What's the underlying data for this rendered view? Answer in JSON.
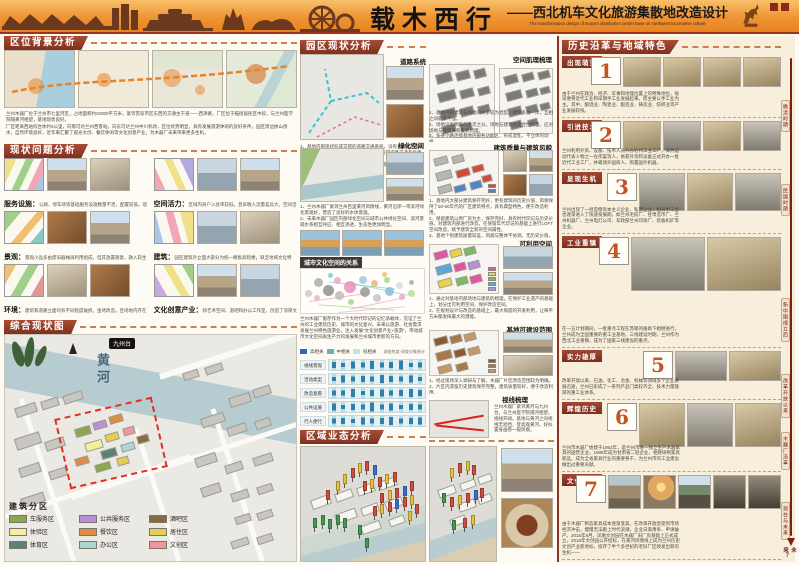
{
  "header": {
    "title": "载木西行",
    "subtitle_cn": "——西北机车文化旅游集散地改造设计",
    "subtitle_en": "The transformation design of tourism distribution center base on northwest locomotive culture"
  },
  "col1": {
    "s1": {
      "title": "区位背景分析",
      "para1": "兰州木器厂位于兰州市七里河区，占地面积约20000平方米，紧邻贯穿市区东西的交通主干道——西津路，厂区位于临街居民区中段，与兰州医学院隔黄河相望，基地现状良好。",
      "para2": "厂区距离西站综合体约5公里，向南可达兰州西客站，向东可达兰州中川机场，区位优势明显，具有发展旅游休闲的良好条件。园区周边依山傍水，自然环境良好，近年来汇聚了观光文创、餐饮休闲等文化创意产业，为木器厂未来带来更多生机。"
    },
    "s2": {
      "title": "现状问题分析",
      "items": [
        {
          "label": "服务设施",
          "text": "公厕、停车场等基础服务设施数量不足，配置较低。现有自行车辆服务基地基本被私家车占用。"
        },
        {
          "label": "空间活力",
          "text": "区域内商户入驻率较低，且早晚人流量差异大，空间活力不足。"
        },
        {
          "label": "景观",
          "text": "景观小品多由废旧器械再利用组成，但其放置随意，融入较生硬，与游客互动少。"
        },
        {
          "label": "建筑",
          "text": "园区建筑外立面大部分为统一模板高程楼，缺乏地域文化特色。各建筑为单体结构，缺乏空间联通。"
        },
        {
          "label": "环境",
          "text": "建筑和道路立面均有不同程度破损，亟待改造。且场地内存在物品乱堆砌现象，有安全隐患。"
        },
        {
          "label": "文化创意产业",
          "text": "除艺术空间、酒吧和办公工作室，创造了浓厚文化氛围，但受到狭窄空间限制，没有形成规模产业链。"
        }
      ]
    },
    "s3": {
      "title": "综合现状图",
      "river_label": "黄河",
      "badge": "九州台",
      "legend_title": "建筑分区",
      "legend": [
        {
          "label": "车服务区",
          "color": "#8ca84e"
        },
        {
          "label": "公共服务区",
          "color": "#b98fd6"
        },
        {
          "label": "酒吧区",
          "color": "#8a6a42"
        },
        {
          "label": "体验区",
          "color": "#f2eda0"
        },
        {
          "label": "餐饮区",
          "color": "#df8c44"
        },
        {
          "label": "居住区",
          "color": "#e3cf52"
        },
        {
          "label": "体育区",
          "color": "#5e8173"
        },
        {
          "label": "办公区",
          "color": "#a9d6d2"
        },
        {
          "label": "文创区",
          "color": "#f2959c"
        }
      ]
    }
  },
  "col2": {
    "title": "园区现状分析",
    "road": {
      "label": "道路系统",
      "text": "1、基地内部现状形成交错的道路交通系统，没有太多车行与步行的区分，道路与设施不协调，应对基地内部道路交通系统重新规划，形成分级、高效的道路交通系统。\n2、规划应考虑未来基地作为西北机车文化旅游集散地的车辆、停车需求，可考虑地下停车场的建设。"
    },
    "green": {
      "label": "绿化空间",
      "text": "1、兰州木器厂紧邻兰州百里黄河风情线，黄河沿岸一带滨河绿化景观好，营造了良好的水体景观。\n2、未来木器厂园区内部绿化空间与城市公共绿化空间、滨河景观水系相互呼应、相互渗透，生态性更加明显。"
    },
    "culture": {
      "label": "城市文化空间的关系",
      "text": "兰州木器厂留存作为一个大时代印记的记忆承载体，见证了兰州的工业建筑历史、城市的文化复兴。未来以旅游、社会需求发展兰州特色旅游业，注入发展“文化创意产业+旅游”，带动城市文化空间再生产力的发展和兰州城市更新的方向。",
      "legend": [
        {
          "label": "高相关",
          "color": "#2b6cb0"
        },
        {
          "label": "中相关",
          "color": "#63b3bd"
        },
        {
          "label": "低相关",
          "color": "#bee3ea"
        }
      ],
      "note": "调查热度·调查对象统计",
      "bubbles": [
        [
          6,
          55,
          7,
          "#c8c8c8"
        ],
        [
          14,
          30,
          9,
          "#a8a8a8"
        ],
        [
          13,
          66,
          6,
          "#e8b0c8"
        ],
        [
          22,
          48,
          11,
          "#8a8a8a"
        ],
        [
          30,
          26,
          7,
          "#f0a0c0"
        ],
        [
          31,
          60,
          9,
          "#b8b8b8"
        ],
        [
          40,
          42,
          12,
          "#e888b0"
        ],
        [
          41,
          74,
          6,
          "#a8d080"
        ],
        [
          50,
          24,
          8,
          "#98c8e0"
        ],
        [
          52,
          52,
          10,
          "#909090"
        ],
        [
          60,
          34,
          7,
          "#f0b070"
        ],
        [
          62,
          66,
          8,
          "#c0c0c0"
        ],
        [
          70,
          26,
          6,
          "#a8d080"
        ],
        [
          72,
          52,
          9,
          "#88b8d8"
        ],
        [
          80,
          38,
          7,
          "#d8d8d8"
        ],
        [
          82,
          64,
          6,
          "#f0a0c0"
        ],
        [
          90,
          30,
          5,
          "#a8a8a8"
        ],
        [
          90,
          56,
          7,
          "#b8d890"
        ],
        [
          24,
          14,
          5,
          "#70c8d8"
        ],
        [
          68,
          12,
          5,
          "#e8c050"
        ]
      ]
    },
    "matrix": {
      "rows": [
        "视线景观",
        "活动类型",
        "改造意愿",
        "公共设施",
        "行人便行"
      ],
      "values": [
        [
          0.55,
          0.35,
          0.7,
          0.45,
          0.8,
          0.5,
          0.6,
          0.85,
          0.4,
          0.5
        ],
        [
          0.4,
          0.7,
          0.5,
          0.6,
          0.45,
          0.8,
          0.6,
          0.5,
          0.7,
          0.35
        ],
        [
          0.5,
          0.45,
          0.8,
          0.35,
          0.6,
          0.7,
          0.5,
          0.6,
          0.8,
          0.55
        ],
        [
          0.7,
          0.4,
          0.6,
          0.5,
          0.85,
          0.45,
          0.7,
          0.4,
          0.6,
          0.5
        ],
        [
          0.45,
          0.6,
          0.35,
          0.7,
          0.5,
          0.6,
          0.8,
          0.45,
          0.55,
          0.7
        ]
      ]
    },
    "business": {
      "title": "区域业态分析",
      "flag_colors": [
        "#3f9c4f",
        "#d24a3a",
        "#e8c23a",
        "#3a6fd2"
      ],
      "flags": [
        [
          10,
          62,
          0
        ],
        [
          16,
          60,
          0
        ],
        [
          22,
          63,
          0
        ],
        [
          28,
          60,
          0
        ],
        [
          34,
          62,
          0
        ],
        [
          20,
          38,
          1
        ],
        [
          28,
          30,
          2
        ],
        [
          34,
          24,
          2
        ],
        [
          40,
          18,
          1
        ],
        [
          46,
          14,
          2
        ],
        [
          52,
          12,
          1
        ],
        [
          58,
          16,
          3
        ],
        [
          50,
          30,
          1
        ],
        [
          56,
          28,
          2
        ],
        [
          62,
          26,
          1
        ],
        [
          68,
          24,
          2
        ],
        [
          74,
          22,
          1
        ],
        [
          64,
          40,
          1
        ],
        [
          70,
          38,
          2
        ],
        [
          76,
          36,
          1
        ],
        [
          82,
          34,
          3
        ],
        [
          88,
          30,
          1
        ],
        [
          58,
          52,
          1
        ],
        [
          64,
          50,
          2
        ],
        [
          70,
          48,
          1
        ],
        [
          76,
          46,
          3
        ],
        [
          82,
          44,
          1
        ],
        [
          88,
          42,
          2
        ],
        [
          46,
          68,
          0
        ],
        [
          52,
          80,
          0
        ],
        [
          86,
          56,
          2
        ],
        [
          92,
          50,
          1
        ]
      ]
    }
  },
  "col3": {
    "texture": {
      "label": "空间肌理梳理",
      "text": "1、基地内部建筑与场地的关系较为混乱，建筑多为一体，互相之间联系不强。\n2、场地没有明确的主次之分，场地与建筑的契合性较差，应对场地与建筑关系重新梳理。\n3、多条小路连接基地内部各功能区，形成混乱、不立体的动线。\n4、同时应对场地进行扩展重组再整合，明确场地的主次关系与不同的功能属性。"
    },
    "quality": {
      "label": "建筑质量与建筑风貌",
      "text": "1、基地内大部分建筑保存完好，更有建筑的历史价值，风貌保持了50-60年代的厂区建筑特点，具有典型特色，便于改造利用。\n2、保留建筑以原厂房为主，保存完好、具有时代印记与历史价值，对建筑内部进行改造，在保留年代印记的基础上进行LOFT空间改造，赋予建筑全新的空间属性。\n3、基地个别建筑质量较差，风貌与整体不协调，无历史价值，规划建设予以拆除，便于改造利用。"
    },
    "usable": {
      "label": "可利用空间",
      "text": "1、通过对基地内部场地与建筑的梳理，在保护工业遗产的基础上，划分出可利用空间、保护改造空间。\n2、在规划设计与改造的基础上，最大限度的开发利用，让每平方米都发挥最大的潜能。"
    },
    "buildable": {
      "label": "基地可建设范围",
      "text": "1、经过现场深入调研与了解，木器厂片区改造范围较为明确。\n2、片区内遗留历史建筑保存完整，建筑质量较好，便于改造利用。"
    },
    "sight": {
      "label": "视线梳理",
      "text": "兰州木器厂紧邻黄河与九州台，与兰州医学院隔河相望，视线开阔。基地与黄河之间视线无遮挡，登高观黄河，好似置身画卷一般风貌。"
    },
    "bottom_flags": [
      [
        30,
        18,
        2
      ],
      [
        42,
        14,
        1
      ],
      [
        54,
        12,
        2
      ],
      [
        64,
        16,
        1
      ],
      [
        18,
        40,
        0
      ],
      [
        30,
        44,
        1
      ],
      [
        42,
        42,
        2
      ],
      [
        54,
        40,
        1
      ],
      [
        66,
        38,
        3
      ],
      [
        76,
        36,
        1
      ],
      [
        34,
        64,
        0
      ],
      [
        50,
        62,
        1
      ],
      [
        62,
        60,
        2
      ]
    ]
  },
  "col4": {
    "title": "历史沿革与地域特色",
    "eras": [
      {
        "num": "1",
        "label": "出现萌芽",
        "text": "由于兰州在政治、经济、军事和地理位置上的特殊地位，很早便将近代工业和早期手工业发展起来，而主要以手工业为主。其中，酿酒业、陶瓷业、酿造业、铸造业、纺织业等产业发展较快。"
      },
      {
        "num": "2",
        "label": "引进技术",
        "text": "兰州利用外资、设备、技术人员兴办近代工业工厂，洋务运动代表人物之一左宗棠等人，依靠外资和设备正式开办一批近代工业工厂，并邀请外国商人、购置国外机器。"
      },
      {
        "num": "3",
        "label": "显现生机",
        "text": "兰州出现了一批官僚资本主义企业、私营企业，相对手工业也逐渐进入了快速发展期，如兰州毛纺厂、甘肃造币厂、兰州机器厂、兰州电灯公司、军政部兰州印染厂、装备机矿等企业。"
      },
      {
        "num": "4",
        "label": "工业重镇",
        "text": "在一五计划期间，一批重点工程在苏联的援助下相继进行，兰州成为全国重要的重工业基地。三线建设时期，兰州作为西北工业重镇，成为了国家三线建设的重点。"
      },
      {
        "num": "5",
        "label": "实力雄厚",
        "text": "改革开放以来，石油、化工、冶金、机械等领域多个企业发展迅速，兰州已形成了一系列产品门类较齐全、技术力量雄厚的重工业体系。"
      },
      {
        "num": "6",
        "label": "辉煌历史",
        "text": "兰州市木器厂始建于1952年，是兰州市唯一独立生产木器家具的国营企业，1989年成为甘肃省二轻企业，相继研制家具新品，成为全省家具行业的重要骨干，为兰州市的工业建设做出过重要贡献。"
      },
      {
        "num": "7",
        "label": "文化空间",
        "text": "由于木器厂制造家具成本逐渐变高，在改革开放后受到市场经济冲击，慢慢无法跟上时代浪潮，企业日渐萧条、申请破产。2016年8月，凤凰文创园在木器厂旧厂房基础上正式成立，2018年文创园公开招标，在黄河风情线上成为兰州历史文创产业新地标，续存了半个多世纪的老旧厂区焕发出新的生机——"
      }
    ],
    "timeline": [
      "晚清时期",
      "民国时期",
      "新中国成立后",
      "改革开放以来",
      "木器厂沿革",
      "现在与未来"
    ],
    "future": "未来？"
  }
}
